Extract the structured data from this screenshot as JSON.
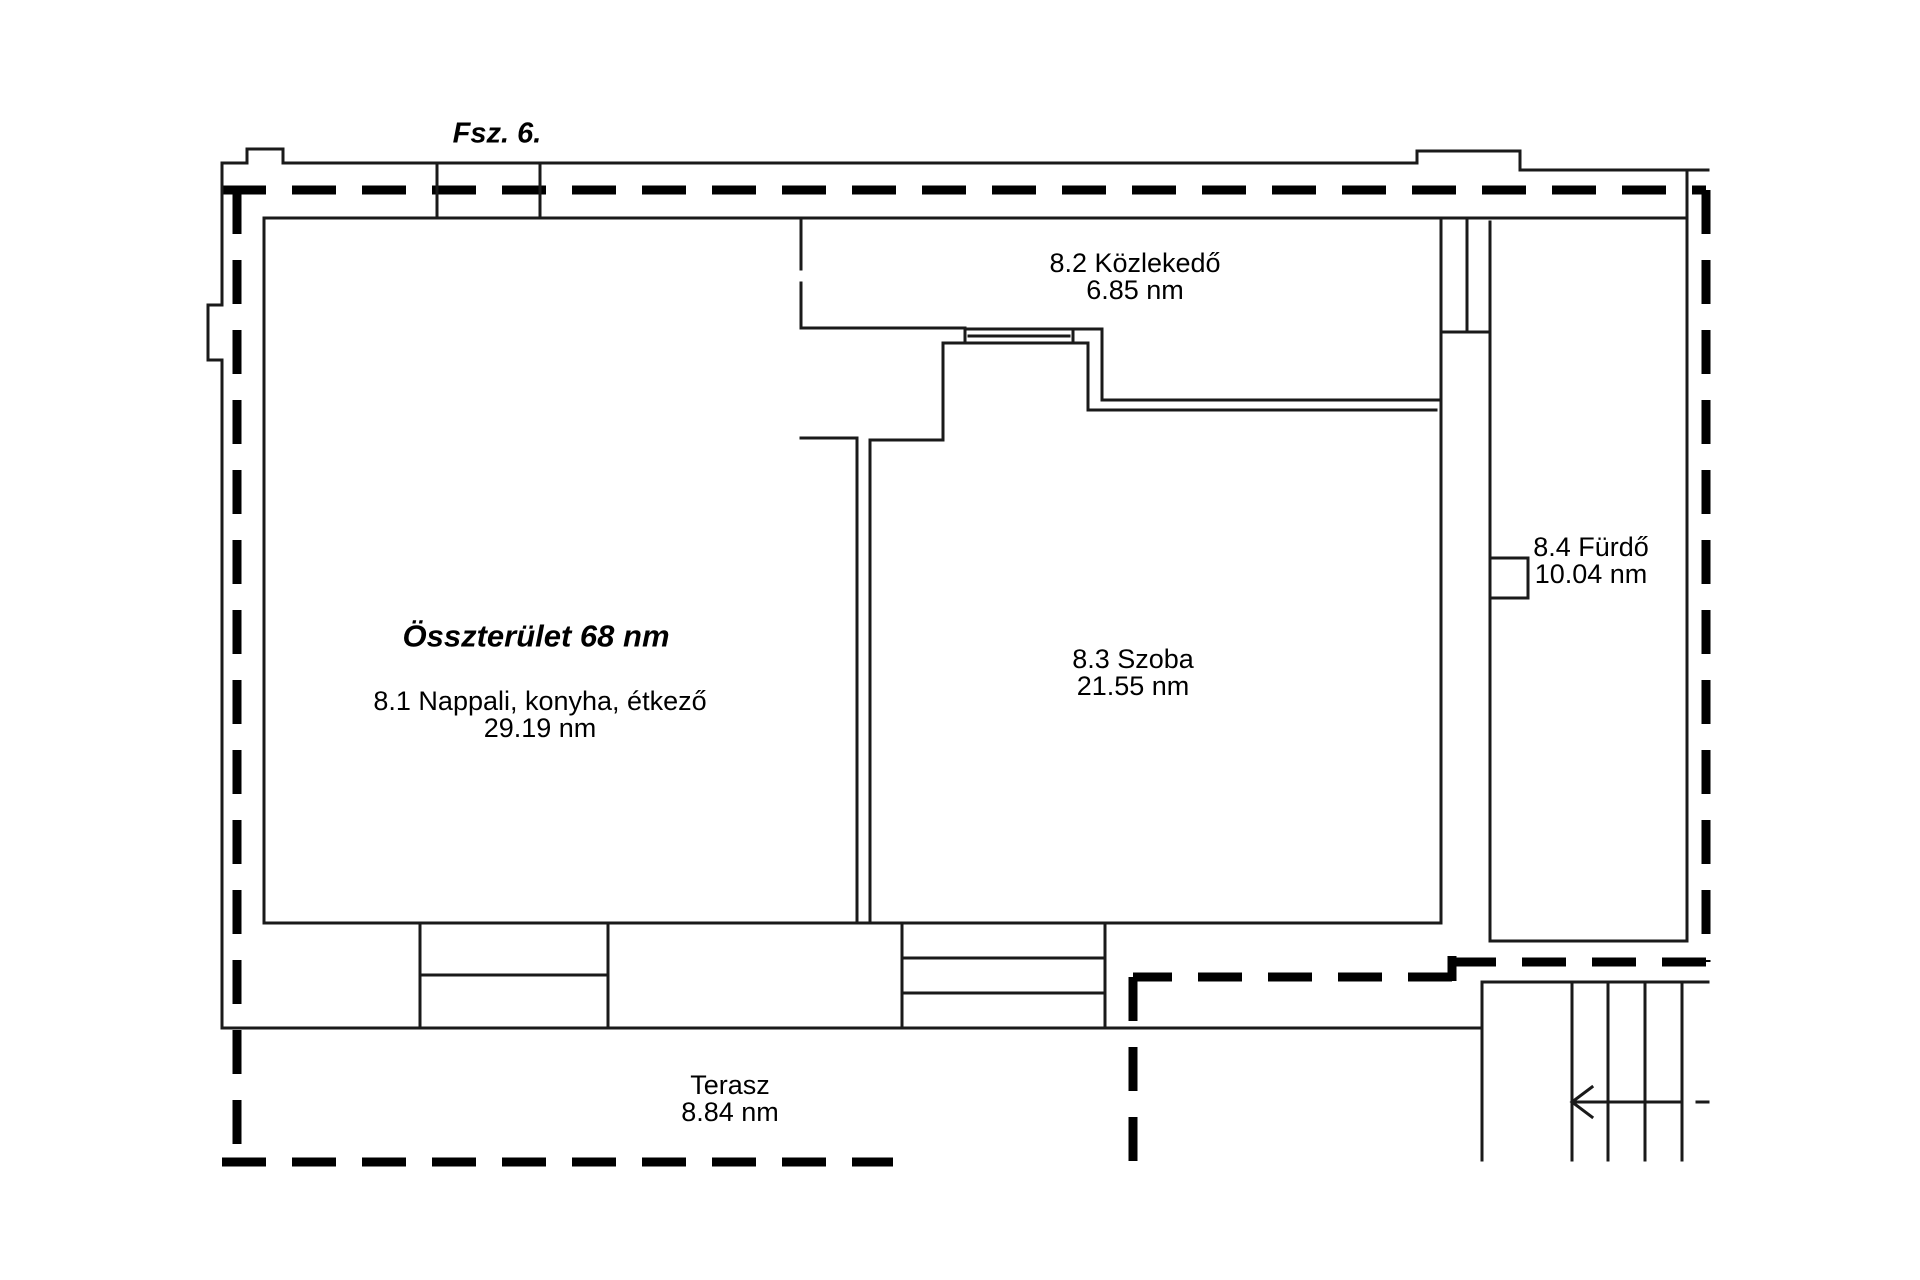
{
  "title": "Fsz. 6.",
  "summary": {
    "total_area": "Összterület 68 nm"
  },
  "rooms": {
    "nappali": {
      "name": "8.1 Nappali, konyha, étkező",
      "area": "29.19 nm"
    },
    "kozlekedo": {
      "name": "8.2 Közlekedő",
      "area": "6.85 nm"
    },
    "szoba": {
      "name": "8.3 Szoba",
      "area": "21.55 nm"
    },
    "furdo": {
      "name": "8.4 Fürdő",
      "area": "10.04 nm"
    },
    "terasz": {
      "name": "Terasz",
      "area": "8.84 nm"
    }
  },
  "colors": {
    "background": "#ffffff",
    "wall_line": "#1a1a1a",
    "boundary_line": "#000000",
    "text": "#000000"
  }
}
